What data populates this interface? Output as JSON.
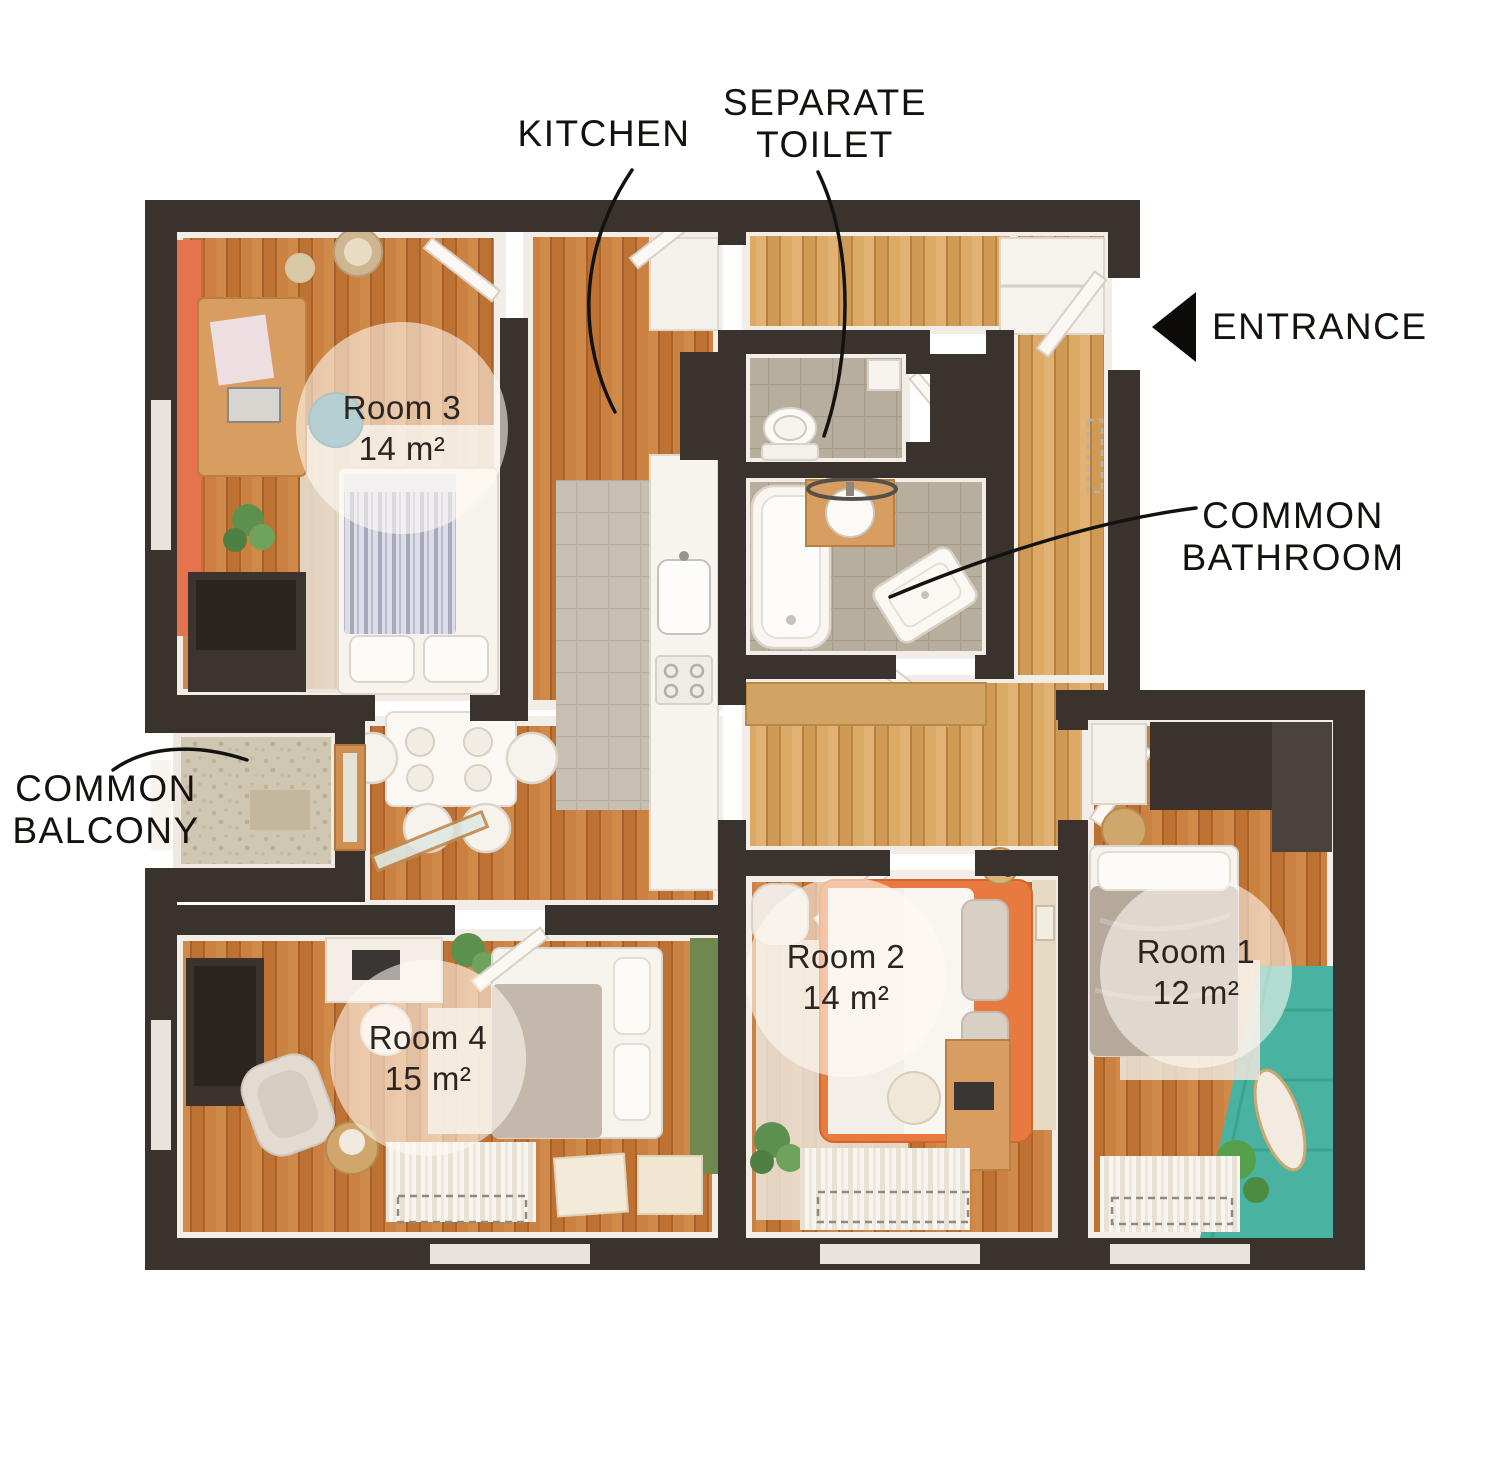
{
  "annotations": {
    "kitchen": "KITCHEN",
    "separate_toilet_line1": "SEPARATE",
    "separate_toilet_line2": "TOILET",
    "entrance": "ENTRANCE",
    "common_bathroom_line1": "COMMON",
    "common_bathroom_line2": "BATHROOM",
    "common_balcony_line1": "COMMON",
    "common_balcony_line2": "BALCONY"
  },
  "rooms": [
    {
      "name": "Room 3",
      "area": "14 m²"
    },
    {
      "name": "Room 2",
      "area": "14 m²"
    },
    {
      "name": "Room 1",
      "area": "12 m²"
    },
    {
      "name": "Room 4",
      "area": "15 m²"
    }
  ],
  "colors": {
    "wall": "#3a322d",
    "wood_floor": "#c57a3b",
    "hall_wood": "#d9a360",
    "tile": "#b8ae9d",
    "balcony_stone": "#d0c7b2",
    "accent_orange_wall": "#e5734d",
    "accent_bed_orange": "#e8793f",
    "accent_teal_wall": "#49b2a1",
    "accent_green_wall": "#6f8850",
    "label_text": "#15110e"
  }
}
